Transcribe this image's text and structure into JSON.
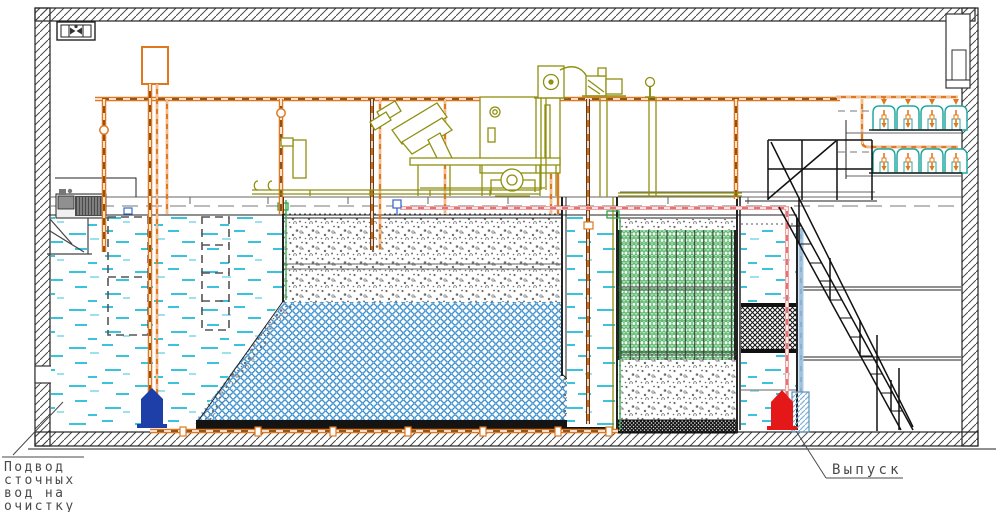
{
  "labels": {
    "inlet": {
      "lines": [
        "Подвод",
        "сточных",
        "вод на",
        "очистку"
      ]
    },
    "outlet": {
      "text": "Выпуск"
    }
  },
  "colors": {
    "pipe_orange": "#e07820",
    "pipe_core_brown": "#7a4a14",
    "equipment_olive": "#8f8f10",
    "media_green": "#2fa546",
    "media_blue": "#2e86c8",
    "water_cyan": "#39c4dc",
    "pipe_pink": "#f2a0a0",
    "pipe_light_blue": "#a8c8e2",
    "pump_inlet_blue": "#1e3ea8",
    "pump_outlet_red": "#e41818",
    "structure_black": "#222222",
    "annotation_gray": "#4a4a4a"
  },
  "icons": {
    "ventilation_fan": "fan-icon"
  }
}
